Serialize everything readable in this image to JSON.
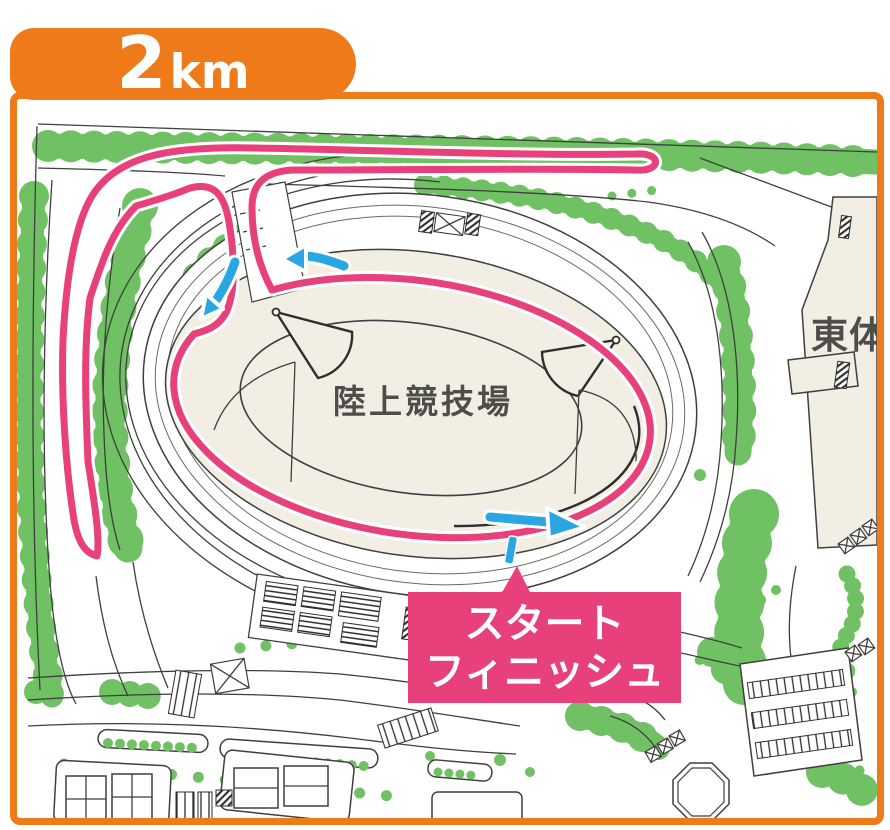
{
  "badge": {
    "distance_value": "2",
    "distance_unit": "km"
  },
  "labels": {
    "stadium": "陸上競技場",
    "building_right": "東体",
    "start_finish_line1": "スタート",
    "start_finish_line2": "フィニッシュ"
  },
  "map": {
    "course_name": "2km course loop around athletics stadium",
    "course_features": [
      "track-loop",
      "north-spur-hairpin",
      "west-spur-hairpin",
      "start-finish-tick",
      "direction-arrows"
    ]
  },
  "colors": {
    "frame_orange": "#ee7a1a",
    "course_pink": "#e8407a",
    "arrow_blue": "#2aa7e2",
    "tree_green": "#6fc163",
    "stadium_beige": "#f2eee3",
    "label_gray": "#4d4d4b"
  }
}
